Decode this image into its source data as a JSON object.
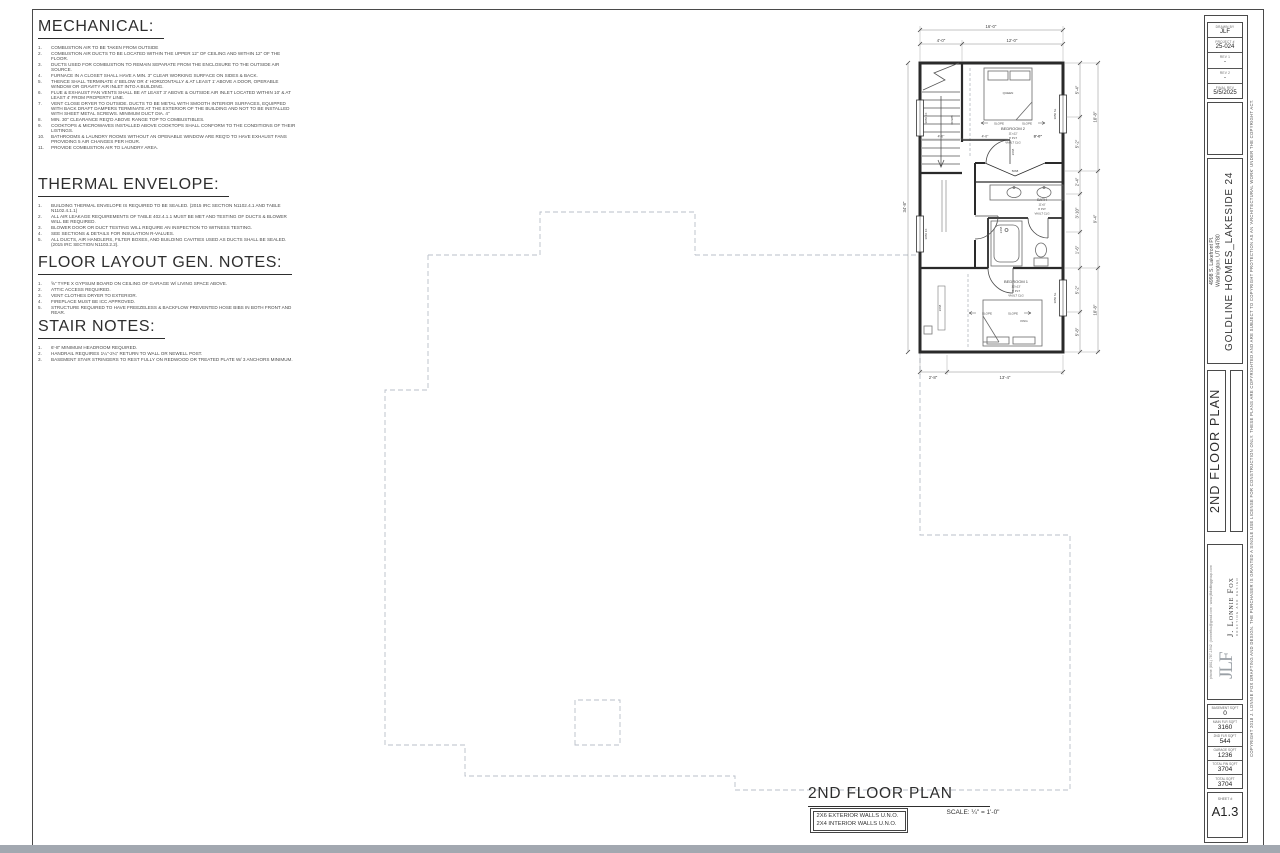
{
  "notes": {
    "mechanical": {
      "title": "MECHANICAL:",
      "items": [
        "COMBUSTION AIR TO BE TAKEN FROM OUTSIDE",
        "COMBUSTION AIR DUCTS TO BE LOCATED WITHIN THE UPPER 12\" OF CEILING AND WITHIN 12\" OF THE FLOOR.",
        "DUCTS USED FOR COMBUSTION TO REMAIN SEPARATE FROM THE ENCLOSURE TO THE OUTSIDE AIR SOURCE.",
        "FURNACE IN A CLOSET SHALL HAVE A MIN. 3\" CLEAR WORKING SURFACE ON SIDES & BACK.",
        "THENCE SHALL TERMINATE 4' BELOW OR 4' HORIZONTALLY & AT LEAST 1' ABOVE A DOOR, OPERABLE WINDOW OR GRAVITY AIR INLET INTO A BUILDING.",
        "FLUE & EXHAUST FAN VENTS SHALL BE AT LEAST 3' ABOVE & OUTSIDE AIR INLET LOCATED WITHIN 10' & AT LEAST 4' FROM PROPERTY LINE.",
        "VENT CLOSE DRYER TO OUTSIDE. DUCTS TO BE METAL WITH SMOOTH INTERIOR SURFACES, EQUIPPED WITH BACK DRAFT DAMPERS TERMINATE AT THE EXTERIOR OF THE BUILDING AND NOT TO BE INSTALLED WITH SHEET METAL SCREWS. MINIMUM DUCT DIA. 4\"",
        "MIN. 30\" CLEARANCE REQ'D ABOVE RANGE TOP TO COMBUSTIBLES.",
        "COOKTOPS & MICROWAVES INSTALLED ABOVE COOKTOPS SHALL CONFORM TO THE CONDITIONS OF THEIR LISTINGS.",
        "BATHROOMS & LAUNDRY ROOMS WITHOUT AN OPENABLE WINDOW ARE REQ'D TO HAVE EXHAUST FANS PROVIDING 5 AIR CHANGES PER HOUR.",
        "PROVIDE COMBUSTION AIR TO LAUNDRY AREA."
      ]
    },
    "thermal": {
      "title": "THERMAL ENVELOPE:",
      "items": [
        "BUILDING THERMAL ENVELOPE IS REQUIRED TO BE SEALED. (2015 IRC SECTION N1102.4.1 AND TABLE N1102.4.1.1)",
        "ALL AIR LEAKAGE REQUIREMENTS OF TABLE 402.4.1.1 MUST BE MET AND TESTING OF DUCTS & BLOWER WILL BE REQUIRED.",
        "BLOWER DOOR OR DUCT TESTING WILL REQUIRE AN INSPECTION TO WITNESS TESTING.",
        "SEE SECTIONS & DETAILS FOR INSULATION R-VALUES.",
        "ALL DUCTS, AIR HANDLERS, FILTER BOXES, AND BUILDING CAVITIES USED AS DUCTS SHALL BE SEALED. (2015 IRC SECTION N1103.2.2)."
      ]
    },
    "floor": {
      "title": "FLOOR LAYOUT GEN. NOTES:",
      "items": [
        "⅝\" TYPE X GYPSUM BOARD ON CEILING OF GARAGE W/ LIVING SPACE ABOVE.",
        "ATTIC ACCESS REQUIRED.",
        "VENT CLOTHES DRYER TO EXTERIOR.",
        "FIREPLACE MUST BE ICC APPROVED.",
        "STRUCTURE REQUIRED TO HAVE FREEZELESS & BACKFLOW PREVENTED HOSE BIBS IN BOTH FRONT AND REAR."
      ]
    },
    "stair": {
      "title": "STAIR NOTES:",
      "items": [
        "6'-8\" MINIMUM HEADROOM REQUIRED.",
        "HANDRAIL REQUIRES 1¼\"-2¼\" RETURN TO WALL OR NEWELL POST.",
        "BASEMENT STAIR STRINGERS TO REST FULLY ON REDWOOD OR TREATED PLATE W/ 3 ANCHORS MINIMUM."
      ]
    }
  },
  "plan": {
    "dims": {
      "top_overall": "16'-0\"",
      "top_left": "4'-0\"",
      "top_right": "12'-0\"",
      "int_1": "4'-0\"",
      "int_2": "4'-0\"",
      "int_3": "8'-0\"",
      "right_1": "5'-4\"",
      "right_2": "5'-2\"",
      "right_3": "2'-4\"",
      "right_4": "3'-10\"",
      "right_5": "1'-6\"",
      "right_6": "5'-2\"",
      "right_7": "5'-8\"",
      "right_out_1": "10'-8\"",
      "right_out_2": "9'-4\"",
      "right_out_3": "10'-8\"",
      "bottom_left": "2'-8\"",
      "bottom_right": "13'-4\"",
      "left_overall": "34'-8\""
    },
    "rooms": {
      "bedroom2": {
        "name": "BEDROOM 2",
        "size": "11'x12'",
        "plate": "9' PLT",
        "ceiling": "VAULT CLG"
      },
      "bath": {
        "name": "BATH",
        "size": "11'x5'",
        "plate": "9' PLT",
        "ceiling": "VAULT CLG"
      },
      "bedroom1": {
        "name": "BEDROOM 1",
        "size": "12'x13'",
        "plate": "9' PLT",
        "ceiling": "VAULT CLG"
      }
    },
    "labels": {
      "queen": "QUEEN",
      "king": "KING",
      "slope": "SLOPE",
      "down": "DOWN",
      "win_left_1": "3050 FX",
      "win_left_2": "3050 FX",
      "win_right_1": "3050 SL",
      "win_right_2": "3050 SL",
      "door_1": "2668",
      "door_2": "2468",
      "door_3": "5068",
      "door_4": "2668"
    }
  },
  "footer": {
    "title": "2ND FLOOR PLAN",
    "scale": "SCALE: ¼\" = 1'-0\"",
    "wall_note_1": "2X6 EXTERIOR WALLS U.N.O.",
    "wall_note_2": "2X4 INTERIOR WALLS U.N.O."
  },
  "titleblock": {
    "info": {
      "drawn_by_label": "DRAWN BY",
      "drawn_by": "JLF",
      "project_label": "PROJECT #",
      "project": "25-024",
      "rev1_label": "REV 1",
      "rev1": "-",
      "rev2_label": "REV 2",
      "rev2": "-",
      "final_label": "FINAL REV",
      "final": "5/5/2025"
    },
    "project_name": "GOLDLINE HOMES_LAKESIDE 24",
    "address_1": "4998 S. Lakefront Pl.",
    "address_2": "Washington, UT 84780",
    "sheet_title": "2ND FLOOR PLAN",
    "firm": {
      "name": "J. Lonnie Fox",
      "tagline": "DRAFTING AND DESIGN",
      "logo": "JLF",
      "contact": "phone (801) 787-1942 : jlonniefox@gmail.com : www.jlfdraftinggroup.com"
    },
    "sqft": {
      "rows": [
        {
          "label": "BASEMENT SQFT",
          "value": "0"
        },
        {
          "label": "MAIN FLR SQFT",
          "value": "3160"
        },
        {
          "label": "2ND FLR SQFT",
          "value": "544"
        },
        {
          "label": "GARAGE SQFT",
          "value": "1236"
        },
        {
          "label": "TOTAL FIN SQFT",
          "value": "3704"
        },
        {
          "label": "TOTAL SQFT",
          "value": "3704"
        }
      ]
    },
    "sheet_label": "SHEET #",
    "sheet_number": "A1.3",
    "copyright": "COPYRIGHT 2018 J. LONNIE FOX DRAFTING AND DESIGN. THE PURCHASER IS GRANTED A SINGLE USE LICENSE FOR CONSTRUCTION ONLY. THESE PLANS ARE COPYRIGHTED AND ARE SUBJECT TO COPYRIGHT PROTECTION AS AN 'ARCHITECTURAL WORK' UNDER THE COPYRIGHT ACT."
  }
}
